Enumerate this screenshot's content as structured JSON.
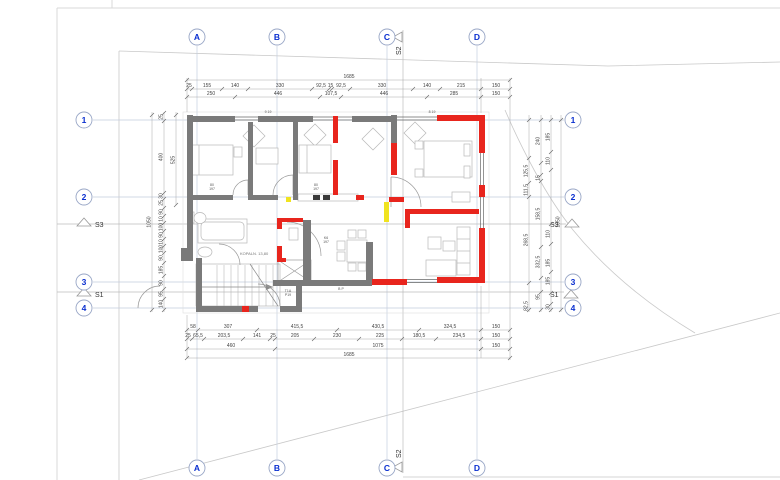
{
  "drawing": {
    "colors": {
      "wall_existing": "#7a7a7a",
      "wall_new": "#e8251d",
      "wall_demolish": "#f0e320",
      "axis_blue": "#0a2fd0"
    },
    "axis_letters": [
      {
        "label": "A",
        "x": 197
      },
      {
        "label": "B",
        "x": 277
      },
      {
        "label": "C",
        "x": 387
      },
      {
        "label": "D",
        "x": 477
      }
    ],
    "axis_numbers": [
      {
        "label": "1",
        "y": 120
      },
      {
        "label": "2",
        "y": 197
      },
      {
        "label": "3",
        "y": 282
      },
      {
        "label": "4",
        "y": 308
      }
    ],
    "bubble_layout": {
      "top_y": 37,
      "bottom_y": 468,
      "left_x": 84,
      "right_x": 573
    },
    "sections": {
      "s1": "S1",
      "s2": "S2",
      "s3": "S3"
    },
    "room_label": {
      "t": "KOPALN. 13,80",
      "x": 240,
      "y": 255
    },
    "micro_labels": [
      {
        "t": "9 19",
        "x": 268,
        "y": 113
      },
      {
        "t": "8 19",
        "x": 432,
        "y": 113
      },
      {
        "t": "80",
        "x": 212,
        "y": 186
      },
      {
        "t": "197",
        "x": 212,
        "y": 190
      },
      {
        "t": "80",
        "x": 316,
        "y": 186
      },
      {
        "t": "197",
        "x": 316,
        "y": 190
      },
      {
        "t": "K6",
        "x": 326,
        "y": 239
      },
      {
        "t": "197",
        "x": 326,
        "y": 243
      },
      {
        "t": "T1A",
        "x": 288,
        "y": 292
      },
      {
        "t": "P19",
        "x": 288,
        "y": 296
      },
      {
        "t": "B P",
        "x": 341,
        "y": 290
      }
    ],
    "dims_top": [
      {
        "y": 80,
        "x1": 187,
        "x2": 510,
        "ticks": [
          187,
          510
        ],
        "labels": [
          {
            "t": "1685",
            "x": 349
          }
        ]
      },
      {
        "y": 89,
        "x1": 187,
        "x2": 510,
        "ticks": [
          187,
          192,
          222,
          248,
          312,
          329,
          332,
          350,
          413,
          440,
          481,
          510
        ],
        "labels": [
          {
            "t": "25",
            "x": 189
          },
          {
            "t": "155",
            "x": 207
          },
          {
            "t": "140",
            "x": 235
          },
          {
            "t": "330",
            "x": 280
          },
          {
            "t": "92,5",
            "x": 321
          },
          {
            "t": "15",
            "x": 330.5
          },
          {
            "t": "92,5",
            "x": 341
          },
          {
            "t": "330",
            "x": 382
          },
          {
            "t": "140",
            "x": 427
          },
          {
            "t": "215",
            "x": 461
          },
          {
            "t": "150",
            "x": 496
          }
        ]
      },
      {
        "y": 97,
        "x1": 187,
        "x2": 510,
        "ticks": [
          187,
          235,
          320,
          341,
          427,
          481,
          510
        ],
        "labels": [
          {
            "t": "250",
            "x": 211
          },
          {
            "t": "446",
            "x": 278
          },
          {
            "t": "107,5",
            "x": 331
          },
          {
            "t": "446",
            "x": 384
          },
          {
            "t": "285",
            "x": 454
          },
          {
            "t": "150",
            "x": 496
          }
        ]
      }
    ],
    "dims_bottom": [
      {
        "y": 330,
        "x1": 187,
        "x2": 510,
        "ticks": [
          187,
          198,
          257,
          337,
          419,
          481,
          510
        ],
        "labels": [
          {
            "t": "58",
            "x": 193
          },
          {
            "t": "307",
            "x": 228
          },
          {
            "t": "415,5",
            "x": 297
          },
          {
            "t": "430,5",
            "x": 378
          },
          {
            "t": "324,5",
            "x": 450
          },
          {
            "t": "150",
            "x": 496
          }
        ]
      },
      {
        "y": 339,
        "x1": 187,
        "x2": 510,
        "ticks": [
          187,
          192,
          204,
          243,
          270,
          275,
          314,
          359,
          402,
          436,
          481,
          510
        ],
        "labels": [
          {
            "t": "25",
            "x": 188
          },
          {
            "t": "65,5",
            "x": 198
          },
          {
            "t": "203,5",
            "x": 224
          },
          {
            "t": "141",
            "x": 257
          },
          {
            "t": "25",
            "x": 273
          },
          {
            "t": "205",
            "x": 295
          },
          {
            "t": "230",
            "x": 337
          },
          {
            "t": "225",
            "x": 380
          },
          {
            "t": "180,5",
            "x": 419
          },
          {
            "t": "234,5",
            "x": 459
          },
          {
            "t": "150",
            "x": 496
          }
        ]
      },
      {
        "y": 349,
        "x1": 187,
        "x2": 510,
        "ticks": [
          187,
          275,
          481,
          510
        ],
        "labels": [
          {
            "t": "460",
            "x": 231
          },
          {
            "t": "1075",
            "x": 378
          },
          {
            "t": "150",
            "x": 496
          }
        ]
      },
      {
        "y": 358,
        "x1": 187,
        "x2": 510,
        "ticks": [
          187,
          510
        ],
        "labels": [
          {
            "t": "1685",
            "x": 349
          }
        ]
      }
    ],
    "dims_left": [
      {
        "x": 152,
        "y1": 112,
        "y2": 312,
        "ticks": [
          115,
          310
        ],
        "labels": [
          {
            "t": "1050",
            "y": 222
          }
        ]
      },
      {
        "x": 164,
        "y1": 112,
        "y2": 312,
        "ticks": [
          113,
          121,
          193,
          199,
          208,
          216,
          223,
          231,
          239,
          246,
          253,
          263,
          276,
          289,
          299,
          310
        ],
        "labels": [
          {
            "t": "25",
            "y": 117
          },
          {
            "t": "400",
            "y": 157
          },
          {
            "t": "30",
            "y": 196
          },
          {
            "t": "25",
            "y": 203
          },
          {
            "t": "90",
            "y": 212
          },
          {
            "t": "10",
            "y": 219
          },
          {
            "t": "100",
            "y": 227
          },
          {
            "t": "90",
            "y": 235
          },
          {
            "t": "10",
            "y": 242
          },
          {
            "t": "100",
            "y": 249
          },
          {
            "t": "90",
            "y": 258
          },
          {
            "t": "185",
            "y": 270
          },
          {
            "t": "90",
            "y": 283
          },
          {
            "t": "95",
            "y": 294
          },
          {
            "t": "140",
            "y": 304
          }
        ]
      },
      {
        "x": 176,
        "y1": 112,
        "y2": 205,
        "ticks": [
          115,
          205
        ],
        "labels": [
          {
            "t": "525",
            "y": 160
          }
        ]
      }
    ],
    "dims_right": [
      {
        "x": 529,
        "y1": 115,
        "y2": 312,
        "ticks": [
          120,
          158,
          183,
          197,
          283,
          310
        ],
        "labels": [
          {
            "t": "125,5",
            "y": 171
          },
          {
            "t": "111,5",
            "y": 190
          },
          {
            "t": "268,5",
            "y": 240
          },
          {
            "t": "82,5",
            "y": 306
          }
        ]
      },
      {
        "x": 541,
        "y1": 115,
        "y2": 312,
        "ticks": [
          120,
          163,
          175,
          181,
          247,
          278,
          292,
          310
        ],
        "labels": [
          {
            "t": "240",
            "y": 141
          },
          {
            "t": "15",
            "y": 178
          },
          {
            "t": "158,5",
            "y": 214
          },
          {
            "t": "332,5",
            "y": 262
          },
          {
            "t": "95",
            "y": 297
          }
        ]
      },
      {
        "x": 551,
        "y1": 115,
        "y2": 312,
        "ticks": [
          120,
          152,
          170,
          224,
          244,
          272,
          293,
          304,
          310
        ],
        "labels": [
          {
            "t": "185",
            "y": 137
          },
          {
            "t": "110",
            "y": 161
          },
          {
            "t": "110",
            "y": 234
          },
          {
            "t": "185",
            "y": 263
          },
          {
            "t": "185",
            "y": 281
          },
          {
            "t": "30",
            "y": 307
          }
        ]
      },
      {
        "x": 561,
        "y1": 115,
        "y2": 312,
        "ticks": [
          120,
          310
        ],
        "labels": [
          {
            "t": "1050",
            "y": 222
          }
        ]
      }
    ]
  }
}
